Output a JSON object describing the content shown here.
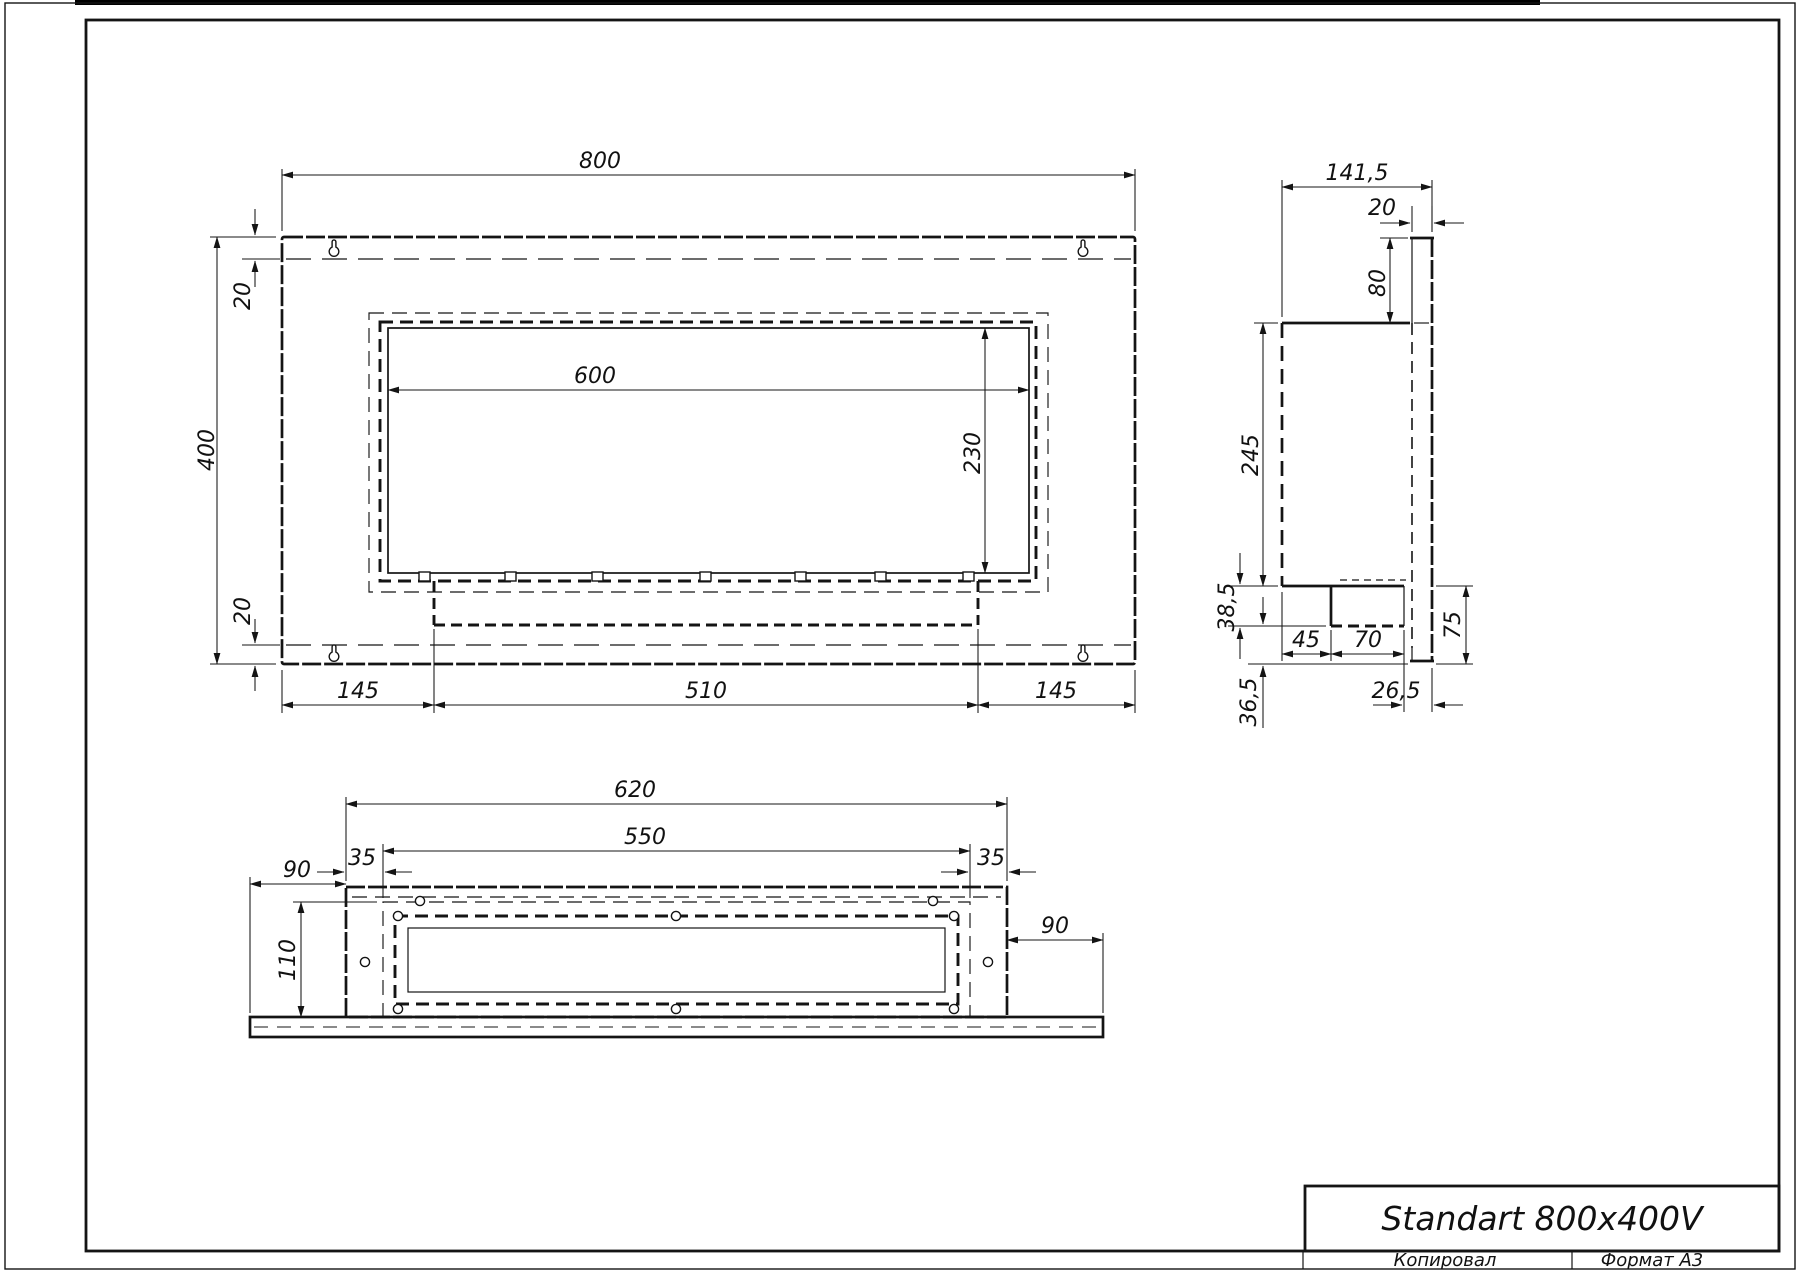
{
  "title_block": {
    "product_name": "Standart 800x400V",
    "copied_label": "Копировал",
    "format_label": "Формат А3"
  },
  "front_view": {
    "width": "800",
    "height": "400",
    "top_fold": "20",
    "bottom_fold": "20",
    "opening_width": "600",
    "opening_height": "230",
    "left_offset": "145",
    "burner_width": "510",
    "right_offset": "145"
  },
  "side_view": {
    "depth": "141,5",
    "flange": "20",
    "top_offset": "80",
    "body_height": "245",
    "burner_height": "38,5",
    "lower_gap": "36,5",
    "burner_offset": "45",
    "burner_depth": "70",
    "bracket_height": "75",
    "bracket_offset": "26,5"
  },
  "bottom_view": {
    "width": "620",
    "inner_width": "550",
    "left_margin": "35",
    "right_margin": "35",
    "left_ext": "90",
    "right_ext": "90",
    "depth": "110"
  }
}
